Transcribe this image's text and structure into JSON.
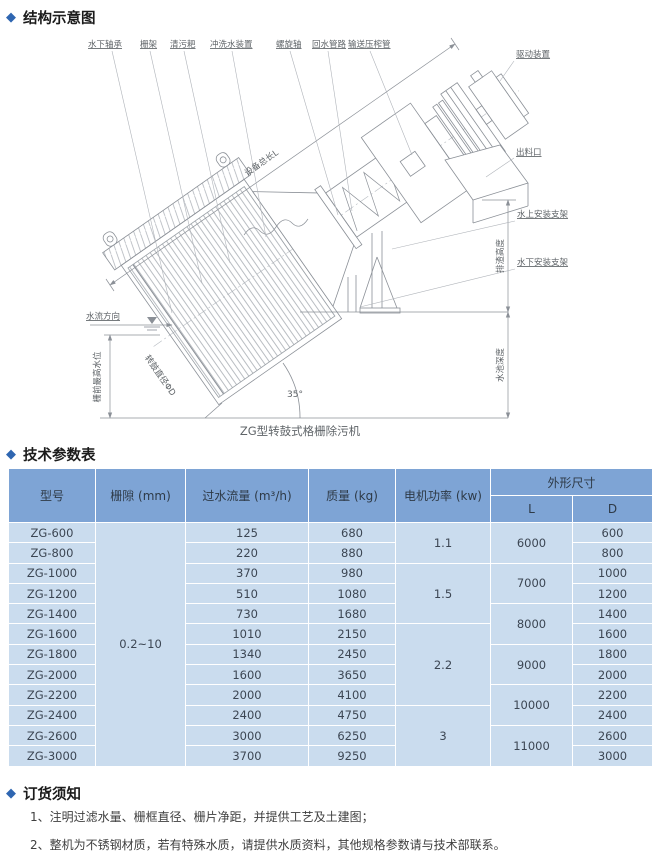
{
  "sections": {
    "structure": {
      "title": "结构示意图"
    },
    "specs": {
      "title": "技术参数表"
    },
    "order": {
      "title": "订货须知"
    }
  },
  "diagram": {
    "caption": "ZG型转鼓式格栅除污机",
    "angle": "35°",
    "labels": {
      "underwater_bearing": "水下轴承",
      "grid_frame": "栅架",
      "rake": "清污耙",
      "flush_device": "冲洗水装置",
      "screw_shaft": "螺旋轴",
      "return_pipe": "回水管路",
      "press_pipe": "输送压榨管",
      "drive": "驱动装置",
      "outlet": "出料口",
      "above_water_bracket": "水上安装支架",
      "under_water_bracket": "水下安装支架",
      "total_length": "设备总长L",
      "discharge_height": "排渣高度",
      "pool_depth": "水池深度",
      "front_water_level": "栅前最高水位",
      "flow_direction": "水流方向",
      "drum_diameter": "转鼓直径ΦD"
    }
  },
  "table": {
    "headers": {
      "model": "型号",
      "gap": "栅隙 (mm)",
      "flow": "过水流量 (m³/h)",
      "mass": "质量 (kg)",
      "power": "电机功率 (kw)",
      "dims": "外形尺寸",
      "L": "L",
      "D": "D"
    },
    "gap": "0.2~10",
    "power": [
      "1.1",
      "1.5",
      "2.2",
      "3"
    ],
    "lengths": [
      "6000",
      "7000",
      "8000",
      "9000",
      "10000",
      "11000"
    ],
    "rows": [
      {
        "model": "ZG-600",
        "flow": "125",
        "mass": "680",
        "d": "600"
      },
      {
        "model": "ZG-800",
        "flow": "220",
        "mass": "880",
        "d": "800"
      },
      {
        "model": "ZG-1000",
        "flow": "370",
        "mass": "980",
        "d": "1000"
      },
      {
        "model": "ZG-1200",
        "flow": "510",
        "mass": "1080",
        "d": "1200"
      },
      {
        "model": "ZG-1400",
        "flow": "730",
        "mass": "1680",
        "d": "1400"
      },
      {
        "model": "ZG-1600",
        "flow": "1010",
        "mass": "2150",
        "d": "1600"
      },
      {
        "model": "ZG-1800",
        "flow": "1340",
        "mass": "2450",
        "d": "1800"
      },
      {
        "model": "ZG-2000",
        "flow": "1600",
        "mass": "3650",
        "d": "2000"
      },
      {
        "model": "ZG-2200",
        "flow": "2000",
        "mass": "4100",
        "d": "2200"
      },
      {
        "model": "ZG-2400",
        "flow": "2400",
        "mass": "4750",
        "d": "2400"
      },
      {
        "model": "ZG-2600",
        "flow": "3000",
        "mass": "6250",
        "d": "2600"
      },
      {
        "model": "ZG-3000",
        "flow": "3700",
        "mass": "9250",
        "d": "3000"
      }
    ]
  },
  "notes": [
    "1、注明过滤水量、栅框直径、栅片净距，并提供工艺及土建图；",
    "2、整机为不锈钢材质，若有特殊水质，请提供水质资料，其他规格参数请与技术部联系。"
  ]
}
